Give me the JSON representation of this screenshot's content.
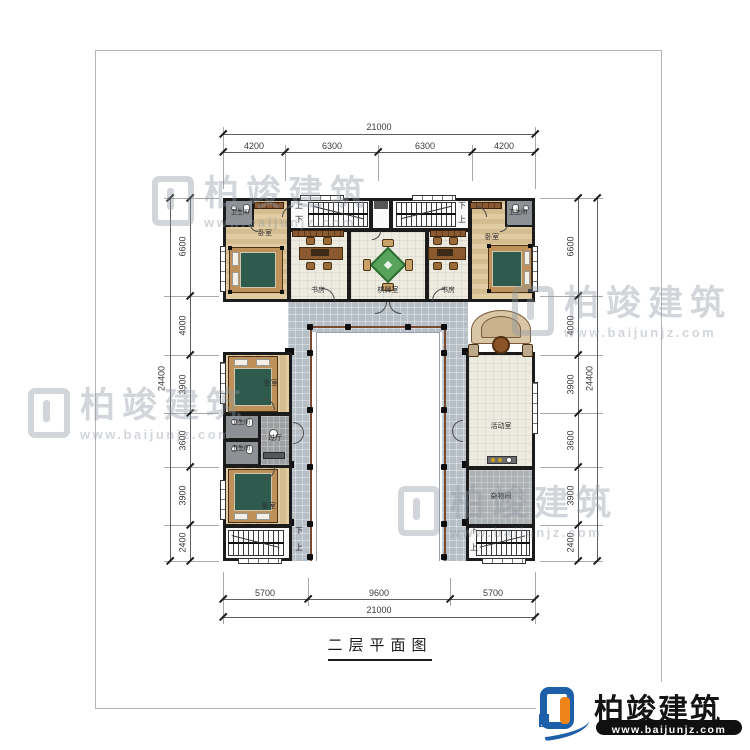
{
  "page": {
    "title": "二层平面图"
  },
  "brand": {
    "name": "柏竣建筑",
    "url": "www.baijunjz.com"
  },
  "rooms": {
    "bedroom": "卧室",
    "bath": "卫生间",
    "study": "书房",
    "chess": "棋牌室",
    "hall": "过厅",
    "activity": "活动室",
    "storage": "杂物间",
    "up": "上",
    "down": "下"
  },
  "dims": {
    "top": {
      "total": "21000",
      "segs": [
        "4200",
        "6300",
        "6300",
        "4200"
      ]
    },
    "bottom": {
      "total": "21000",
      "segs": [
        "5700",
        "9600",
        "5700"
      ]
    },
    "left": {
      "total": "24400",
      "segs": [
        "6600",
        "4000",
        "3900",
        "3600",
        "3900",
        "2400"
      ]
    },
    "right": {
      "total": "24400",
      "segs": [
        "6600",
        "4000",
        "3900",
        "3600",
        "3900",
        "2400"
      ]
    }
  },
  "colors": {
    "wall": "#1b1b1b",
    "walkway": "#b6bec6",
    "railing": "#7a4a30",
    "accent_blue": "#1d5fa9",
    "accent_orange": "#ef8418",
    "mahjong_green": "#57a35b"
  }
}
